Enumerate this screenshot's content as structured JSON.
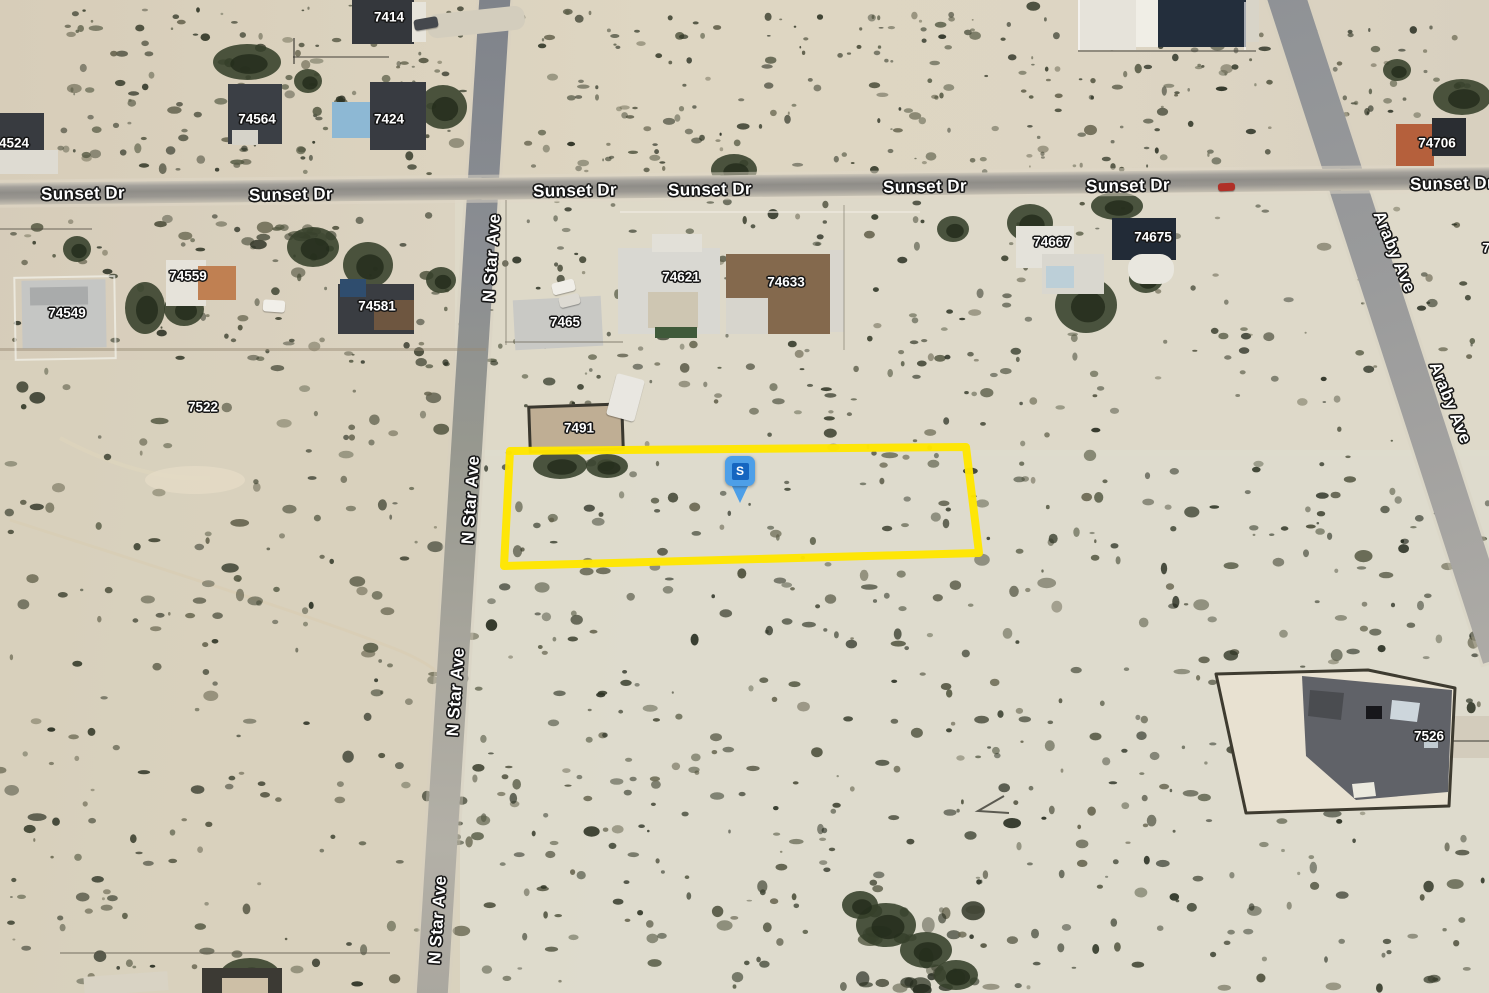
{
  "map": {
    "view_type": "satellite-imagery",
    "highlight_color": "#FFE600",
    "marker": {
      "letter": "S",
      "outer_color": "#4D9FE8",
      "inner_color": "#1565C0",
      "tip_x": 740,
      "tip_y": 503
    },
    "highlighted_parcel": {
      "points": [
        [
          510,
          451
        ],
        [
          966,
          447
        ],
        [
          979,
          553
        ],
        [
          504,
          566
        ]
      ],
      "stroke_width": 8
    },
    "streets": [
      {
        "name": "Sunset Dr",
        "rotation": -1,
        "labels": [
          [
            83,
            194
          ],
          [
            291,
            195
          ],
          [
            575,
            191
          ],
          [
            710,
            190
          ],
          [
            925,
            187
          ],
          [
            1128,
            186
          ],
          [
            1452,
            184
          ]
        ]
      },
      {
        "name": "N Star Ave",
        "rotation": -86,
        "labels": [
          [
            492,
            258
          ],
          [
            471,
            500
          ],
          [
            456,
            692
          ],
          [
            438,
            920
          ]
        ]
      },
      {
        "name": "Araby Ave",
        "rotation": 68,
        "labels": [
          [
            1394,
            252
          ],
          [
            1450,
            403
          ]
        ]
      }
    ],
    "parcel_numbers": [
      {
        "text": "7414",
        "x": 389,
        "y": 17
      },
      {
        "text": "74564",
        "x": 257,
        "y": 119
      },
      {
        "text": "7424",
        "x": 389,
        "y": 119
      },
      {
        "text": "4524",
        "x": 14,
        "y": 143
      },
      {
        "text": "74549",
        "x": 67,
        "y": 313
      },
      {
        "text": "74559",
        "x": 188,
        "y": 276
      },
      {
        "text": "74581",
        "x": 377,
        "y": 306
      },
      {
        "text": "7465",
        "x": 565,
        "y": 322
      },
      {
        "text": "74621",
        "x": 681,
        "y": 277
      },
      {
        "text": "74633",
        "x": 786,
        "y": 282
      },
      {
        "text": "74667",
        "x": 1052,
        "y": 242
      },
      {
        "text": "74675",
        "x": 1153,
        "y": 237
      },
      {
        "text": "74706",
        "x": 1437,
        "y": 143
      },
      {
        "text": "7522",
        "x": 203,
        "y": 407
      },
      {
        "text": "7491",
        "x": 579,
        "y": 428
      },
      {
        "text": "7526",
        "x": 1429,
        "y": 736
      },
      {
        "text": "7",
        "x": 1486,
        "y": 248
      }
    ]
  }
}
